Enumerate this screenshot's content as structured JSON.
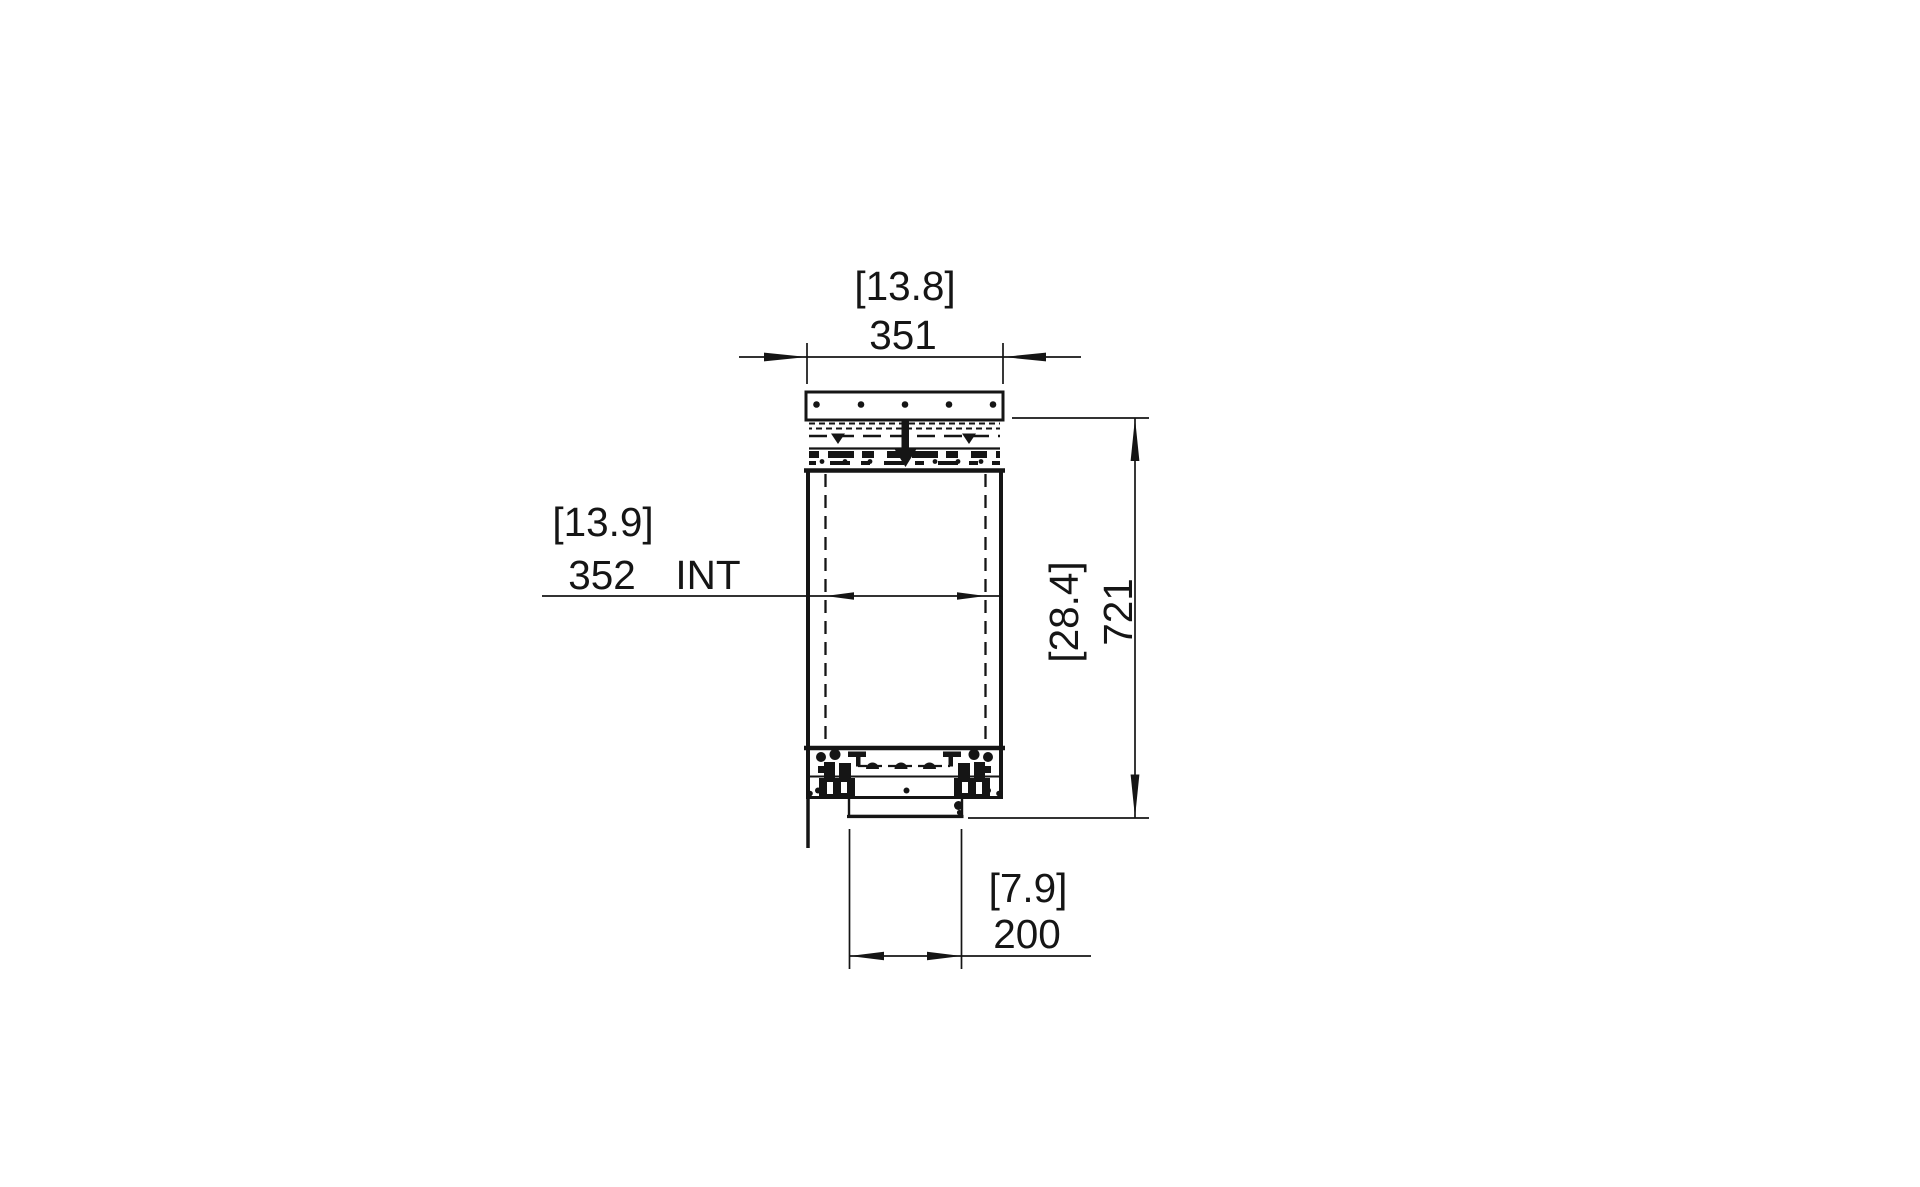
{
  "canvas": {
    "background": "#ffffff",
    "ink": "#151515"
  },
  "drawing": {
    "kind": "technical section drawing (front cross-section with dimensions)",
    "units": "millimetres with [inches] in brackets",
    "dims": {
      "top_width": {
        "imperial": "[13.8]",
        "metric": "351"
      },
      "interior_width": {
        "imperial": "[13.9]",
        "metric": "352",
        "suffix": "INT"
      },
      "overall_height": {
        "imperial": "[28.4]",
        "metric": "721"
      },
      "bottom_width": {
        "imperial": "[7.9]",
        "metric": "200"
      }
    }
  }
}
